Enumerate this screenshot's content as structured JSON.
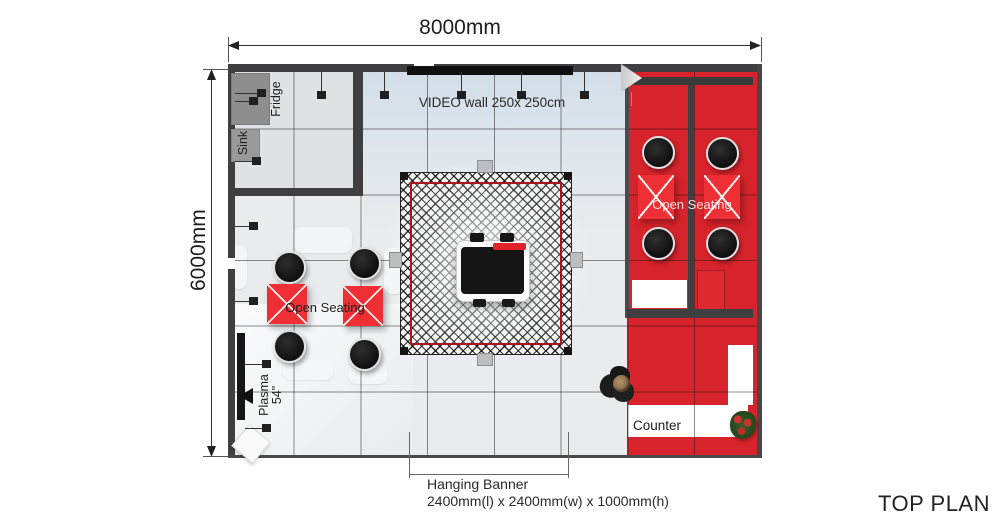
{
  "title": "TOP PLAN",
  "dims": {
    "width_label": "8000mm",
    "height_label": "6000mm"
  },
  "annotations": {
    "video_wall": "VIDEO wall 250x 250cm",
    "hanging_banner": {
      "title": "Hanging Banner",
      "size": "2400mm(l) x 2400mm(w) x 1000mm(h)"
    }
  },
  "rooms": {
    "kitchen": {
      "fridge": "Fridge",
      "sink": "Sink"
    },
    "seating_left": {
      "label": "Open Seating"
    },
    "seating_right": {
      "label": "Open Seating"
    },
    "media": {
      "plasma": "Plasma",
      "plasma_size": "54\""
    },
    "counter": {
      "label": "Counter"
    }
  },
  "colors": {
    "red_floor": "#d7232b",
    "red_table": "#ee2f36",
    "desk_accent": "#e0222a",
    "wall": "#3f3f42",
    "truss_border": "#a8151b"
  }
}
